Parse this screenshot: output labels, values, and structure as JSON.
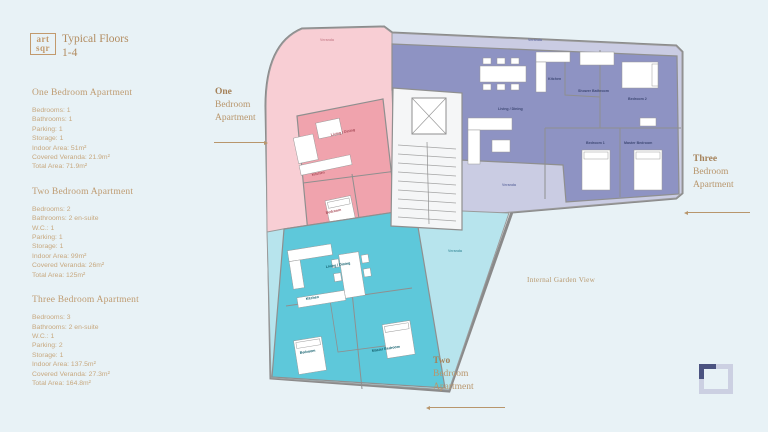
{
  "header": {
    "logo_line1": "art",
    "logo_line2": "sqr",
    "title": "Typical Floors",
    "floors": "1-4"
  },
  "sidebar": {
    "sections": [
      {
        "heading": "One Bedroom Apartment",
        "lines": [
          "Bedrooms: 1",
          "Bathrooms: 1",
          "Parking: 1",
          "Storage: 1",
          "Indoor Area: 51m²",
          "Covered Veranda: 21.9m²",
          "Total Area: 71.9m²"
        ]
      },
      {
        "heading": "Two Bedroom Apartment",
        "lines": [
          "Bedrooms: 2",
          "Bathrooms: 2 en-suite",
          "W.C.: 1",
          "Parking: 1",
          "Storage: 1",
          "Indoor Area: 99m²",
          "Covered Veranda: 26m²",
          "Total Area: 125m²"
        ]
      },
      {
        "heading": "Three Bedroom Apartment",
        "lines": [
          "Bedrooms: 3",
          "Bathrooms: 2 en-suite",
          "W.C.: 1",
          "Parking: 2",
          "Storage: 1",
          "Indoor Area: 137.5m²",
          "Covered Veranda: 27.3m²",
          "Total Area: 164.8m²"
        ]
      }
    ]
  },
  "callouts": {
    "one": {
      "emphasis": "One",
      "line2": "Bedroom",
      "line3": "Apartment"
    },
    "two": {
      "emphasis": "Two",
      "line2": "Bedroom",
      "line3": "Apartment"
    },
    "three": {
      "emphasis": "Three",
      "line2": "Bedroom",
      "line3": "Apartment"
    },
    "garden": "Internal Garden View"
  },
  "rooms": {
    "one_bed": {
      "living": "Living / Dining",
      "kitchen": "Kitchen",
      "bedroom": "Bedroom",
      "veranda": "Veranda"
    },
    "three_bed": {
      "veranda": "Veranda",
      "living": "Living / Dining",
      "kitchen": "Kitchen",
      "shower_bathroom": "Shower Bathroom",
      "bedroom1": "Bedroom 1",
      "bedroom2": "Bedroom 2",
      "master_bedroom": "Master Bedroom"
    },
    "two_bed": {
      "living": "Living / Dining",
      "kitchen": "Kitchen",
      "bedroom": "Bedroom",
      "master_bedroom": "Master Bedroom",
      "veranda": "Veranda"
    }
  },
  "icons": {
    "brand_logo": "artsqr-logo",
    "corner_frame": "frame-icon"
  },
  "colors": {
    "background": "#e8f2f6",
    "accent_text": "#bf9c72",
    "one_bed_fill": "#f0a3ad",
    "one_bed_veranda": "#f8ced4",
    "three_bed_fill": "#8e93c3",
    "three_bed_veranda": "#cacce3",
    "two_bed_fill": "#5ec8da",
    "two_bed_veranda": "#b7e4ed",
    "wall": "#8a8a8a"
  }
}
